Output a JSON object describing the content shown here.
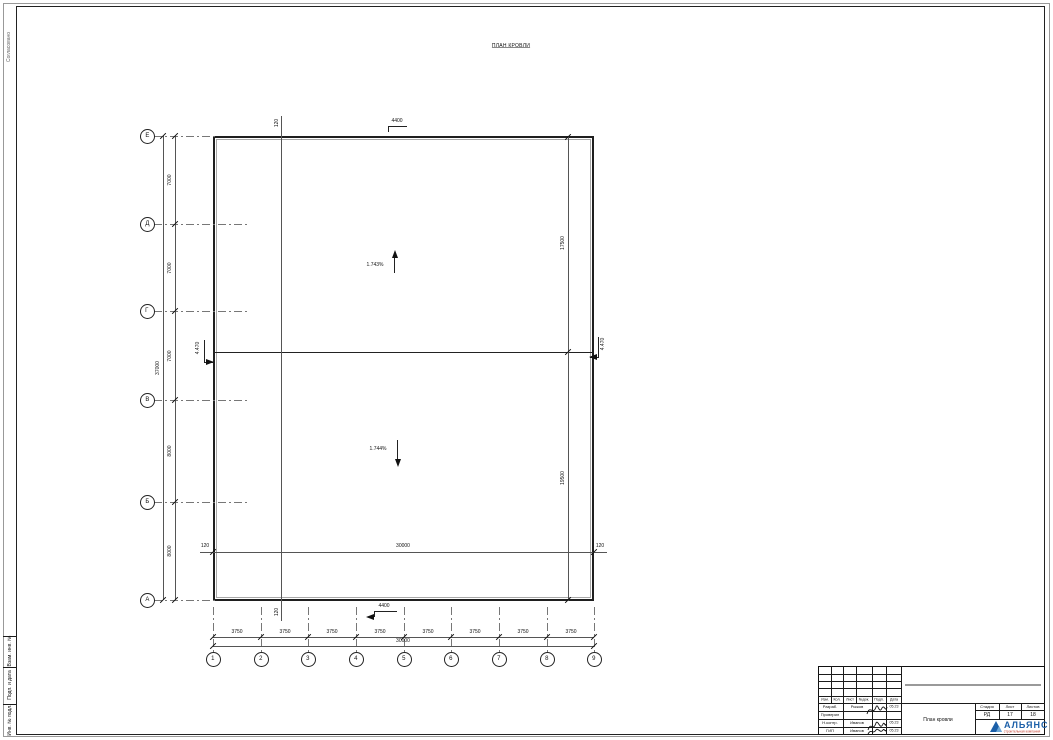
{
  "drawing": {
    "title": "ПЛАН КРОВЛИ",
    "row_axes": [
      "Е",
      "Д",
      "Г",
      "В",
      "Б",
      "А"
    ],
    "col_axes": [
      "1",
      "2",
      "3",
      "4",
      "5",
      "6",
      "7",
      "8",
      "9"
    ],
    "left_dims": {
      "segments": [
        "7000",
        "7000",
        "7000",
        "8000",
        "8000"
      ],
      "overall": "37000"
    },
    "bottom_dims": {
      "segments": [
        "3750",
        "3750",
        "3750",
        "3750",
        "3750",
        "3750",
        "3750",
        "3750"
      ],
      "overall": "30000"
    },
    "inner_dims": {
      "vertical": [
        "17500",
        "19500"
      ],
      "horizontal": {
        "label": "30000",
        "left_end": "120",
        "right_end": "120"
      },
      "parapet_top": "120",
      "parapet_bottom": "120"
    },
    "slopes": [
      {
        "value": "1.743%",
        "direction": "up"
      },
      {
        "value": "1.744%",
        "direction": "down"
      }
    ],
    "elevation_marks": {
      "top": "4400",
      "bottom": "4400",
      "left": "4.470",
      "right": "4.470"
    }
  },
  "titleblock": {
    "revision_headers": [
      "Изм.",
      "Кол.",
      "Лист",
      "№док.",
      "Подп.",
      "Дата"
    ],
    "rows": [
      {
        "role": "Разраб.",
        "name": "Рыжов",
        "date": "05.23"
      },
      {
        "role": "Проверил",
        "name": "",
        "date": ""
      },
      {
        "role": "Н.контр.",
        "name": "Иванов",
        "date": "05.23"
      },
      {
        "role": "ГИП",
        "name": "Иванов",
        "date": "05.23"
      }
    ],
    "doc_title": "План кровли",
    "stage": {
      "headers": [
        "Стадия",
        "Лист",
        "Листов"
      ],
      "values": [
        "РД",
        "17",
        "18"
      ]
    },
    "logo": {
      "name": "АЛЬЯНС",
      "subtitle": "строительная компания",
      "accent": "#1b5fa8",
      "subtitle_color": "#c03a2b"
    }
  },
  "margin": {
    "top_label": "Согласовано",
    "cells": [
      "Взам. инв. №",
      "Подп. и дата",
      "Инв. № подл."
    ]
  }
}
